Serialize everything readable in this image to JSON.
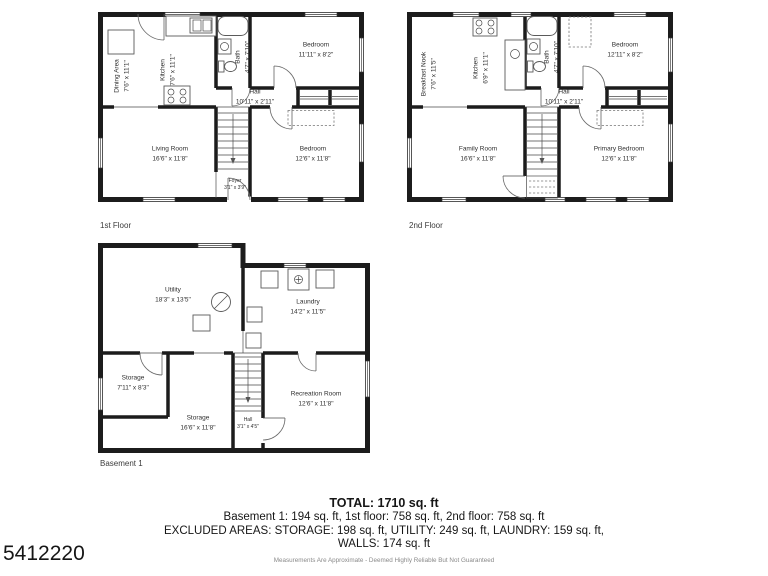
{
  "watermark": "5412220",
  "floors": [
    {
      "label": "1st Floor",
      "rooms": {
        "dining": {
          "name": "Dining Area",
          "dims": "7'6\" x 11'1\""
        },
        "kitchen": {
          "name": "Kitchen",
          "dims": "7'6\" x 11'1\""
        },
        "bath": {
          "name": "Bath",
          "dims": "4'7\" x 7'10\""
        },
        "bedroom1": {
          "name": "Bedroom",
          "dims": "11'11\" x 8'2\""
        },
        "hall": {
          "name": "Hall",
          "dims": "10'11\" x 2'11\""
        },
        "living": {
          "name": "Living Room",
          "dims": "16'6\" x 11'8\""
        },
        "bedroom2": {
          "name": "Bedroom",
          "dims": "12'6\" x 11'8\""
        },
        "foyer": {
          "name": "Foyer",
          "dims": "3'1\" x 3'9\""
        }
      }
    },
    {
      "label": "2nd Floor",
      "rooms": {
        "nook": {
          "name": "Breakfast Nook",
          "dims": "7'6\" x 11'5\""
        },
        "kitchen": {
          "name": "Kitchen",
          "dims": "6'9\" x 11'1\""
        },
        "bath": {
          "name": "Bath",
          "dims": "4'7\" x 7'10\""
        },
        "bedroom1": {
          "name": "Bedroom",
          "dims": "12'11\" x 8'2\""
        },
        "hall": {
          "name": "Hall",
          "dims": "10'11\" x 2'11\""
        },
        "family": {
          "name": "Family Room",
          "dims": "16'6\" x 11'8\""
        },
        "primary": {
          "name": "Primary Bedroom",
          "dims": "12'6\" x 11'8\""
        }
      }
    },
    {
      "label": "Basement 1",
      "rooms": {
        "utility": {
          "name": "Utility",
          "dims": "18'3\" x 13'5\""
        },
        "laundry": {
          "name": "Laundry",
          "dims": "14'2\" x 11'5\""
        },
        "storage1": {
          "name": "Storage",
          "dims": "7'11\" x 8'3\""
        },
        "storage2": {
          "name": "Storage",
          "dims": "16'6\" x 11'8\""
        },
        "hall": {
          "name": "Hall",
          "dims": "3'1\" x 4'5\""
        },
        "rec": {
          "name": "Recreation Room",
          "dims": "12'6\" x 11'8\""
        }
      }
    }
  ],
  "summary": {
    "total": "TOTAL: 1710 sq. ft",
    "by_floor": "Basement 1: 194 sq. ft, 1st floor: 758 sq. ft, 2nd floor: 758 sq. ft",
    "excluded": "EXCLUDED AREAS: STORAGE: 198 sq. ft, UTILITY: 249 sq. ft, LAUNDRY: 159 sq. ft,",
    "walls": "WALLS: 174 sq. ft",
    "disclaimer": "Measurements Are Approximate - Deemed Highly Reliable But Not Guaranteed"
  }
}
